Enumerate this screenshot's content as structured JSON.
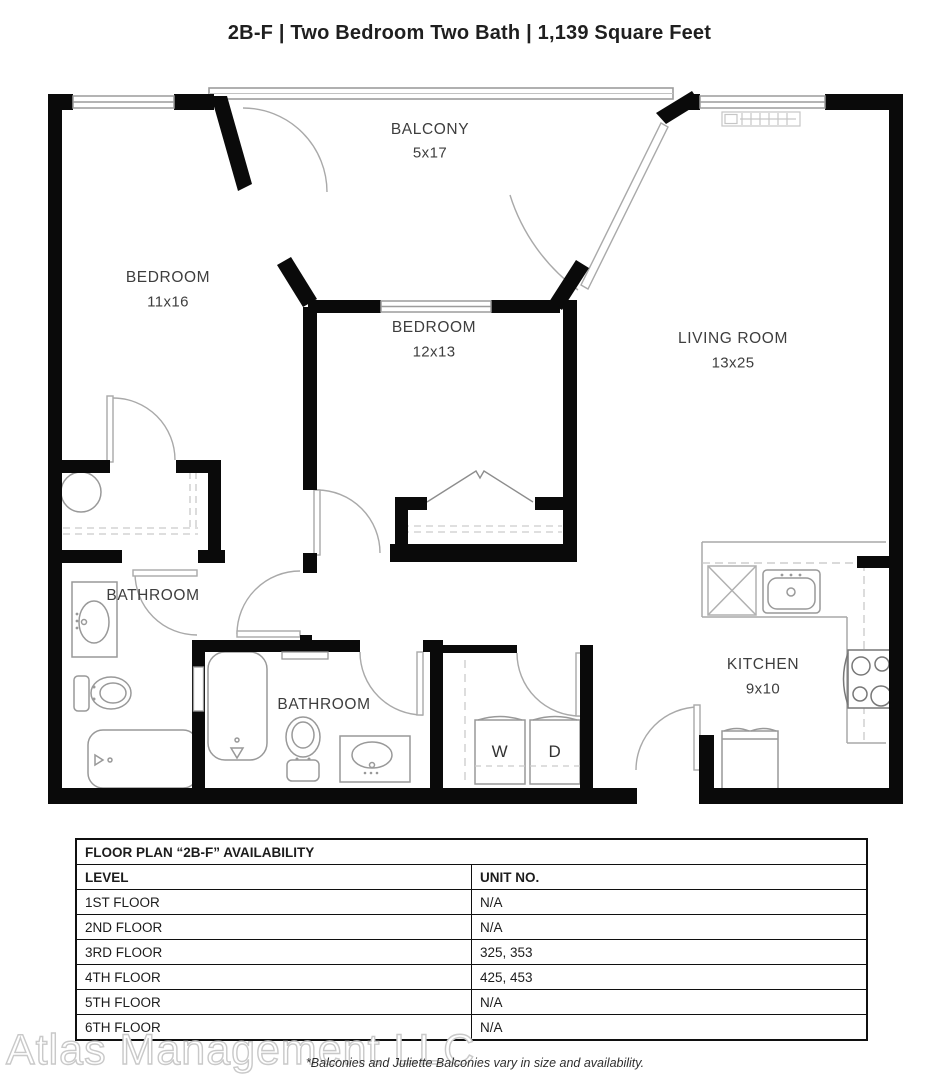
{
  "title": "2B-F | Two Bedroom Two Bath | 1,139 Square Feet",
  "rooms": {
    "balcony": {
      "name": "BALCONY",
      "dims": "5x17"
    },
    "bedroom1": {
      "name": "BEDROOM",
      "dims": "11x16"
    },
    "bedroom2": {
      "name": "BEDROOM",
      "dims": "12x13"
    },
    "living": {
      "name": "LIVING ROOM",
      "dims": "13x25"
    },
    "bathroom1": {
      "name": "BATHROOM"
    },
    "bathroom2": {
      "name": "BATHROOM"
    },
    "kitchen": {
      "name": "KITCHEN",
      "dims": "9x10"
    },
    "washer": "W",
    "dryer": "D"
  },
  "availability_table": {
    "title": "FLOOR PLAN “2B-F” AVAILABILITY",
    "columns": [
      "LEVEL",
      "UNIT NO."
    ],
    "rows": [
      [
        "1ST FLOOR",
        "N/A"
      ],
      [
        "2ND FLOOR",
        "N/A"
      ],
      [
        "3RD FLOOR",
        "325, 353"
      ],
      [
        "4TH FLOOR",
        "425, 453"
      ],
      [
        "5TH FLOOR",
        "N/A"
      ],
      [
        "6TH FLOOR",
        "N/A"
      ]
    ]
  },
  "footnote": "*Balconies and Juliette Balconies vary in size and availability.",
  "watermark": "Atlas Management LLC",
  "colors": {
    "wall": "#0a0a0a",
    "fixture": "#999999",
    "label": "#3e3e3e"
  }
}
